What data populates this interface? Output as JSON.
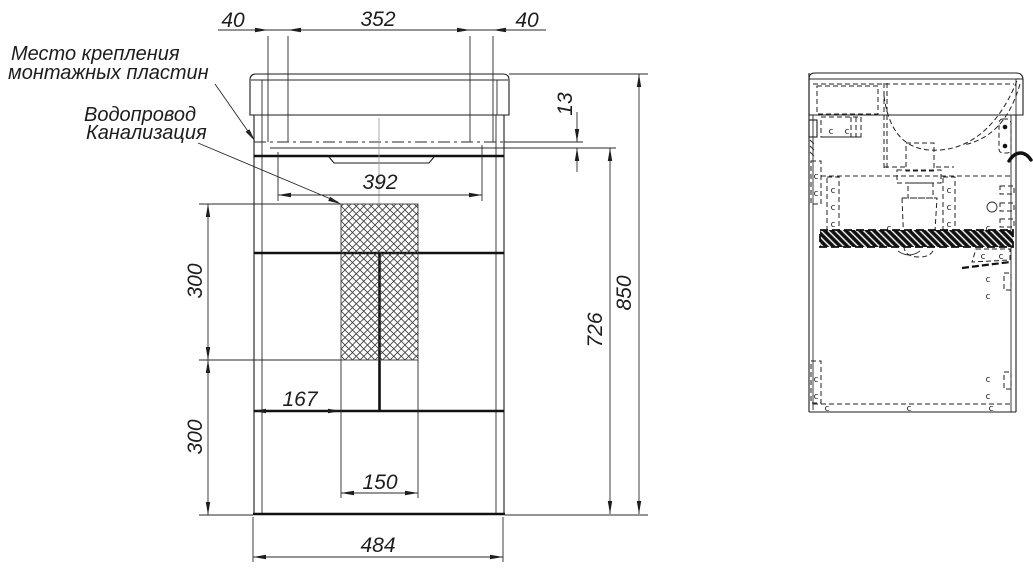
{
  "drawing": {
    "labels": {
      "mounting_plates": {
        "line1": "Место крепления",
        "line2": "монтажных пластин"
      },
      "plumbing": {
        "line1": "Водопровод",
        "line2": "Канализация"
      }
    },
    "dims": {
      "top_margin_left": "40",
      "top_span": "352",
      "top_margin_right": "40",
      "basin_drop": "13",
      "opening_width": "392",
      "service_upper": "300",
      "service_lower": "300",
      "carcass_height": "726",
      "overall_height": "850",
      "left_offset": "167",
      "service_width": "150",
      "overall_width": "484"
    },
    "side_view": {
      "screw_mark": "c"
    }
  }
}
